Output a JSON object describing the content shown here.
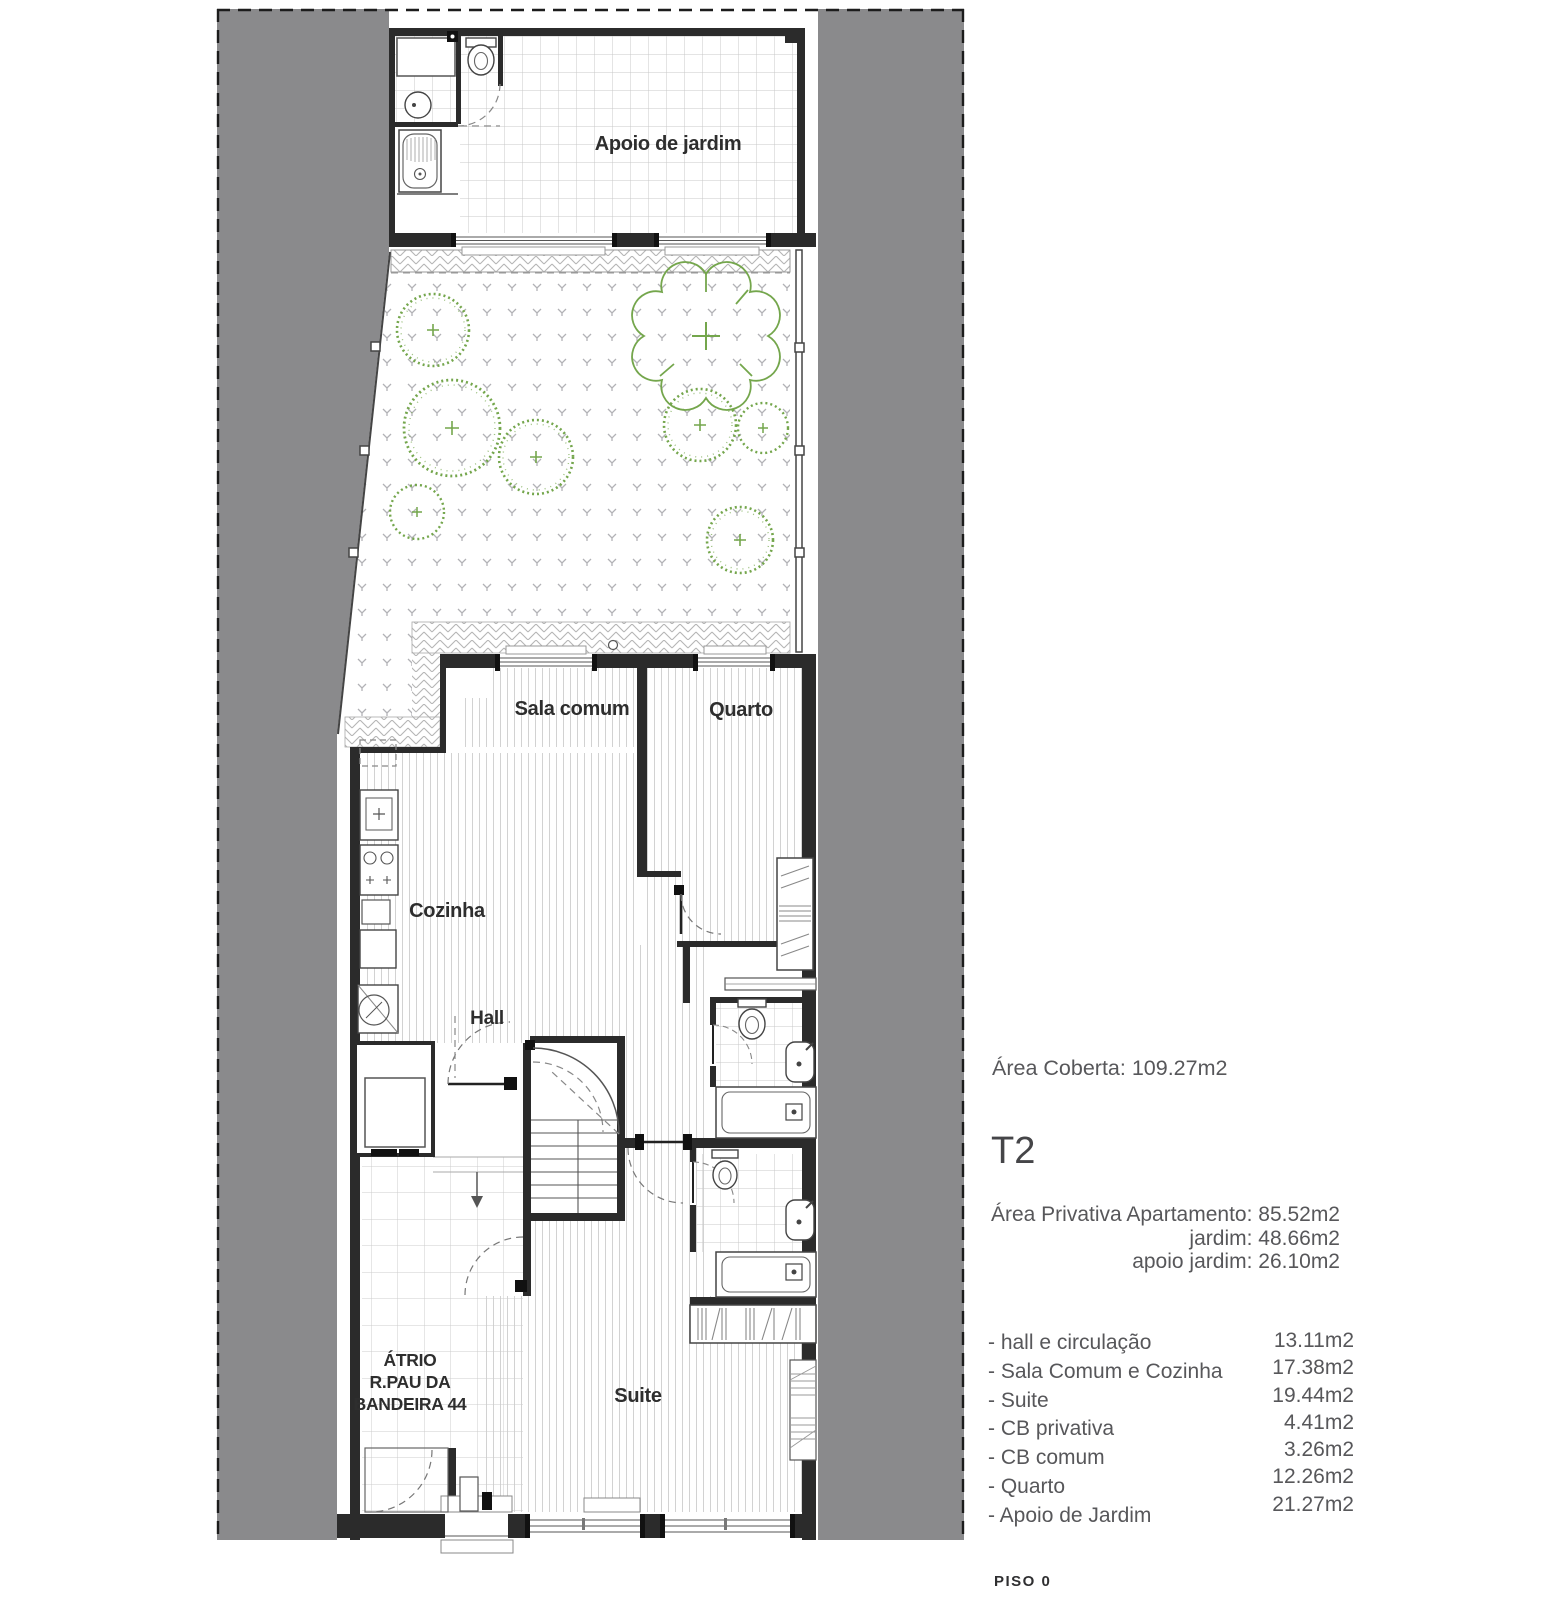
{
  "plan": {
    "rooms": {
      "apoio_de_jardim": "Apoio de jardim",
      "sala_comum": "Sala comum",
      "quarto": "Quarto",
      "cozinha": "Cozinha",
      "hall": "Hall",
      "atrio_line1": "ÁTRIO",
      "atrio_line2": "R.PAU DA",
      "atrio_line3": "BANDEIRA 44",
      "suite": "Suite"
    }
  },
  "info": {
    "area_coberta": "Área Coberta: 109.27m2",
    "typology": "T2",
    "private_areas": [
      "Área Privativa Apartamento: 85.52m2",
      "jardim: 48.66m2",
      "apoio jardim:  26.10m2"
    ],
    "room_areas": [
      {
        "label": "- hall e circulação",
        "value": "13.11m2"
      },
      {
        "label": "- Sala Comum e Cozinha",
        "value": "17.38m2"
      },
      {
        "label": "- Suite",
        "value": "19.44m2"
      },
      {
        "label": "- CB privativa",
        "value": "4.41m2"
      },
      {
        "label": "- CB comum",
        "value": "3.26m2"
      },
      {
        "label": "- Quarto",
        "value": "12.26m2"
      },
      {
        "label": "- Apoio de Jardim",
        "value": "21.27m2"
      }
    ],
    "floor_label": "PISO 0"
  },
  "colors": {
    "neighbor_band": "#8a8a8c",
    "wall": "#2b2b2b",
    "vegetation": "#74a64c",
    "text_gray": "#57575a"
  }
}
